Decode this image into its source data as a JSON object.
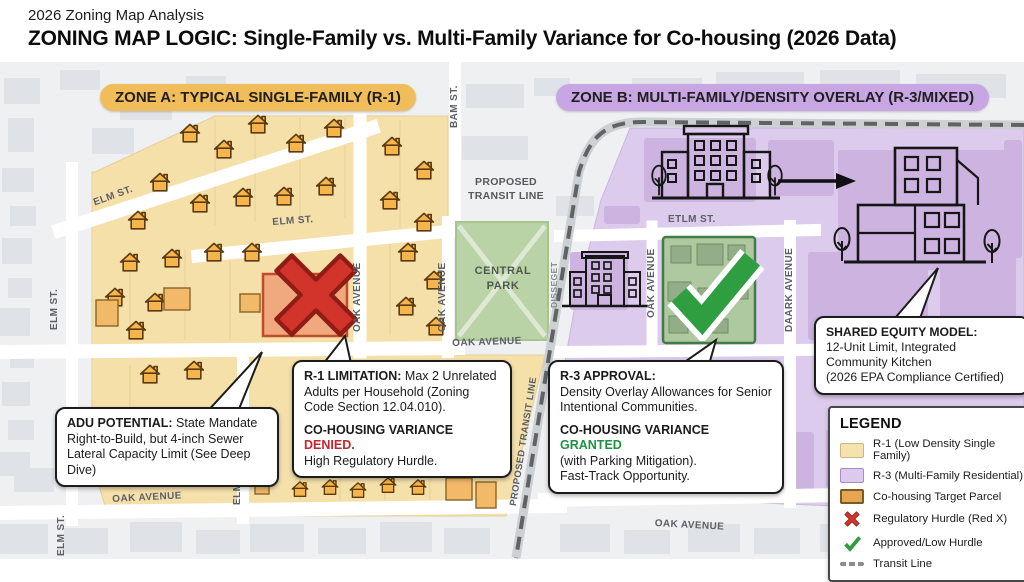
{
  "header": {
    "kicker": "2026 Zoning Map Analysis",
    "title": "ZONING MAP LOGIC: Single-Family vs. Multi-Family Variance for Co-housing (2026 Data)"
  },
  "zone_a": {
    "prefix": "ZONE A:",
    "name": "TYPICAL SINGLE-FAMILY (R-1)"
  },
  "zone_b": {
    "prefix": "ZONE B:",
    "name": "MULTI-FAMILY/DENSITY OVERLAY (R-3/MIXED)"
  },
  "map": {
    "streets": {
      "elm": "ELM ST.",
      "oak": "OAK AVENUE",
      "bam": "BAM ST.",
      "etlm": "ETLM ST.",
      "daark": "DAARK AVENUE",
      "disseget": "DISSEGET"
    },
    "park_line1": "CENTRAL",
    "park_line2": "PARK",
    "transit_label_line1": "PROPOSED",
    "transit_label_line2": "TRANSIT LINE",
    "transit_label_rotated": "PROPOSED TRANSIT LINE"
  },
  "callouts": {
    "adu": {
      "title": "ADU POTENTIAL:",
      "body": "State Mandate Right-to-Build, but 4-inch Sewer Lateral Capacity Limit (See Deep Dive)"
    },
    "r1": {
      "title": "R-1 LIMITATION:",
      "body": "Max 2 Unrelated Adults per Household (Zoning Code Section 12.04.010).",
      "variance": "CO-HOUSING VARIANCE",
      "status": "DENIED.",
      "note": "High Regulatory Hurdle."
    },
    "r3": {
      "title": "R-3 APPROVAL:",
      "body": "Density Overlay Allowances for Senior Intentional Communities.",
      "variance": "CO-HOUSING VARIANCE",
      "status": "GRANTED",
      "note1": "(with Parking Mitigation).",
      "note2": "Fast-Track Opportunity."
    },
    "equity": {
      "title": "SHARED EQUITY MODEL:",
      "line1": "12-Unit Limit, Integrated",
      "line2": "Community Kitchen",
      "line3": "(2026 EPA Compliance Certified)"
    }
  },
  "legend": {
    "title": "LEGEND",
    "items": [
      {
        "icon": "r1-swatch",
        "label": "R-1 (Low Density Single Family)"
      },
      {
        "icon": "r3-swatch",
        "label": "R-3 (Multi-Family Residential)"
      },
      {
        "icon": "cohousing-swatch",
        "label": "Co-housing Target Parcel"
      },
      {
        "icon": "red-x-icon",
        "label": "Regulatory Hurdle (Red X)"
      },
      {
        "icon": "green-check-icon",
        "label": "Approved/Low Hurdle"
      },
      {
        "icon": "transit-line-icon",
        "label": "Transit Line"
      }
    ]
  },
  "colors": {
    "r1_fill": "#f5e0aa",
    "r3_fill": "#dccbec",
    "cohousing_fill": "#f0a87e",
    "park_green": "#b9d3a6",
    "denied_red": "#c2272d",
    "granted_green": "#1f9242",
    "red_x": "#d2342c",
    "check_green": "#2f9e41",
    "zone_a_pill": "#f1bd5b",
    "zone_b_pill": "#c7a6e3",
    "transit_gray": "#5f6366"
  }
}
